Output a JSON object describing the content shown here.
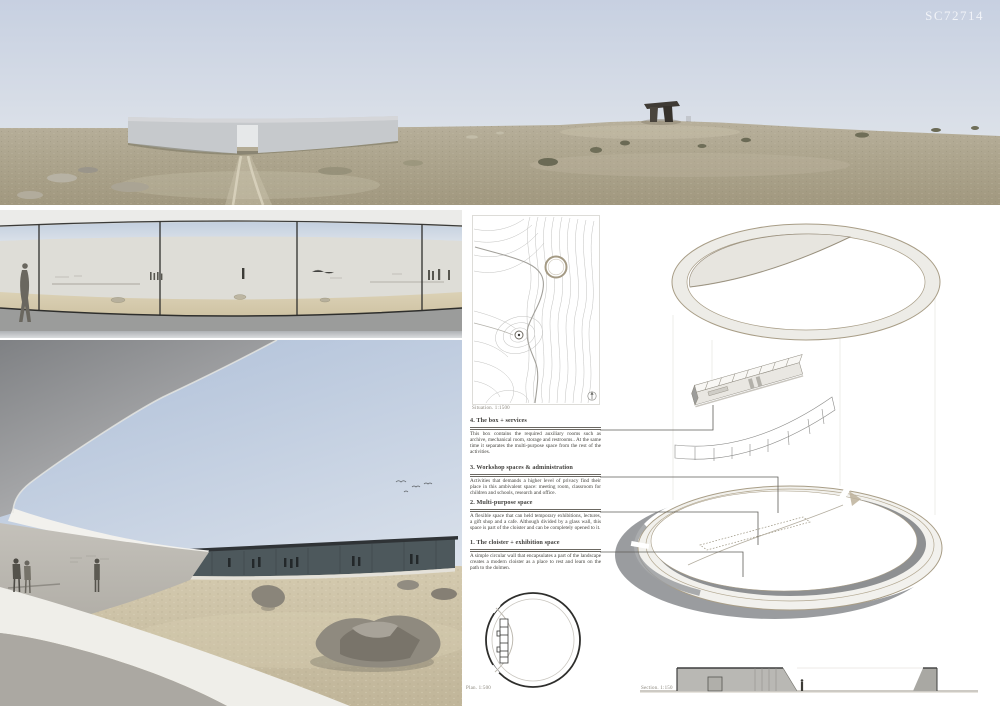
{
  "board": {
    "code": "SC72714"
  },
  "colors": {
    "sky": "#c9d2e2",
    "ground": "#b2aa96",
    "panel_background": "#ffffff",
    "ink": "#3f3e3b",
    "drawing_tan": "#a89d86",
    "shadow_gray": "#8e9092"
  },
  "site_plan": {
    "caption": "Situation. 1:1500"
  },
  "plan": {
    "caption": "Plan. 1:500"
  },
  "section": {
    "caption": "Section. 1:150"
  },
  "annotations": {
    "items": [
      {
        "title": "4. The box + services",
        "body": "This box contains the required auxiliary rooms such as archive, mechanical room, storage and restrooms.. At the same time it separates the multi-purpose space from the rest of the activities."
      },
      {
        "title": "3. Workshop spaces & administration",
        "body": "Activities that demands a higher level of privacy find their place in this ambivalent space: meeting room, classroom for children and schools, research and office."
      },
      {
        "title": "2. Multi-purpose space",
        "body": "A flexible space that can held temporary exhibitions, lectures, a gift shop and a cafe. Although divided by a glass wall, this space is part of the cloister and can be completely opened to it."
      },
      {
        "title": "1. The cloister + exhibition space",
        "body": "A simple circular wall that encapsulates a part of the landscape creates a modern cloister as a place to rest and learn on the path to the dolmen."
      }
    ]
  }
}
